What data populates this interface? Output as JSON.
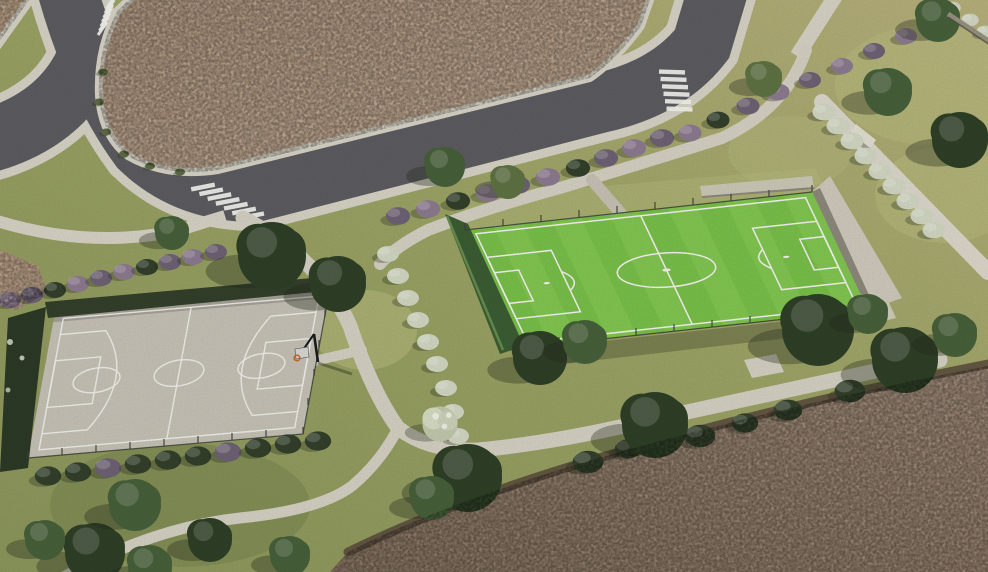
{
  "meta": {
    "title": "Aerial rendering - neighborhood sports park",
    "type": "3D architectural visualization",
    "view": "aerial oblique bird's-eye",
    "width_px": 988,
    "height_px": 572
  },
  "palette": {
    "grass": "#99a163",
    "grassLight": "#babe80",
    "grassDark": "#74814c",
    "road": "#5c5c61",
    "sidewalk": "#d7d3c6",
    "path": "#d5d1c3",
    "walkway": "#dcd8cb",
    "dirtLot": "#c2a78e",
    "dirtField": "#9c8672",
    "mulch": "#584a3b",
    "turf": "#79c04a",
    "turfLight": "#8ed05c",
    "line": "#f4f4ef",
    "court": "#c6c2b6",
    "hedgeDark": "#33402b",
    "hedgeWall": "#3c5d33",
    "hedgePurple": "#8d7b90",
    "hedgePurple2": "#6e6274",
    "hedgeWhite": "#d3d8c4",
    "treeDark": "#2f4027",
    "treeMid": "#47603a",
    "treeOlive": "#5e7344",
    "wall": "#cfcabc",
    "wallShade": "#8d897c",
    "pole": "#1c1c1c",
    "rim": "#c96a2f",
    "shadow": "#262b1c"
  },
  "scene": {
    "description": "Aerial 3D rendering of a residential sports park: a fenced artificial-turf mini soccer field and a concrete basketball court set in landscaped grounds with walking paths, mauve and white flowering hedgerows, scattered trees, an asphalt street loop with three zebra crosswalks around a graded empty lot, and bare-earth fields at the edges.",
    "elements": [
      {
        "id": "street",
        "label": "Asphalt street with curbs and sidewalks"
      },
      {
        "id": "crosswalks",
        "label": "Zebra crosswalks",
        "count": 3
      },
      {
        "id": "unbuilt-lot",
        "label": "Graded earth lot awaiting development"
      },
      {
        "id": "soccer-field",
        "label": "Artificial-turf mini soccer field with white markings, perimeter fence, green windbreak wall and concrete retaining wall"
      },
      {
        "id": "basketball-court",
        "label": "Concrete basketball court with white markings, hoop and perimeter fence"
      },
      {
        "id": "paths",
        "label": "Concrete pedestrian paths and a walkway with a bench"
      },
      {
        "id": "hedges",
        "label": "Flowering hedgerows (mauve and white) and clipped dark hedges"
      },
      {
        "id": "trees",
        "label": "Scattered broadleaf trees casting shadows"
      },
      {
        "id": "bare-field",
        "label": "Bare earth field in the lower right"
      }
    ],
    "sports": {
      "soccer_field_markings": [
        "center circle",
        "center line",
        "penalty areas",
        "goal areas",
        "penalty arcs",
        "penalty spots"
      ],
      "basketball_markings": [
        "boundary",
        "center circle",
        "center line",
        "three-point arcs",
        "free-throw keys"
      ]
    }
  }
}
